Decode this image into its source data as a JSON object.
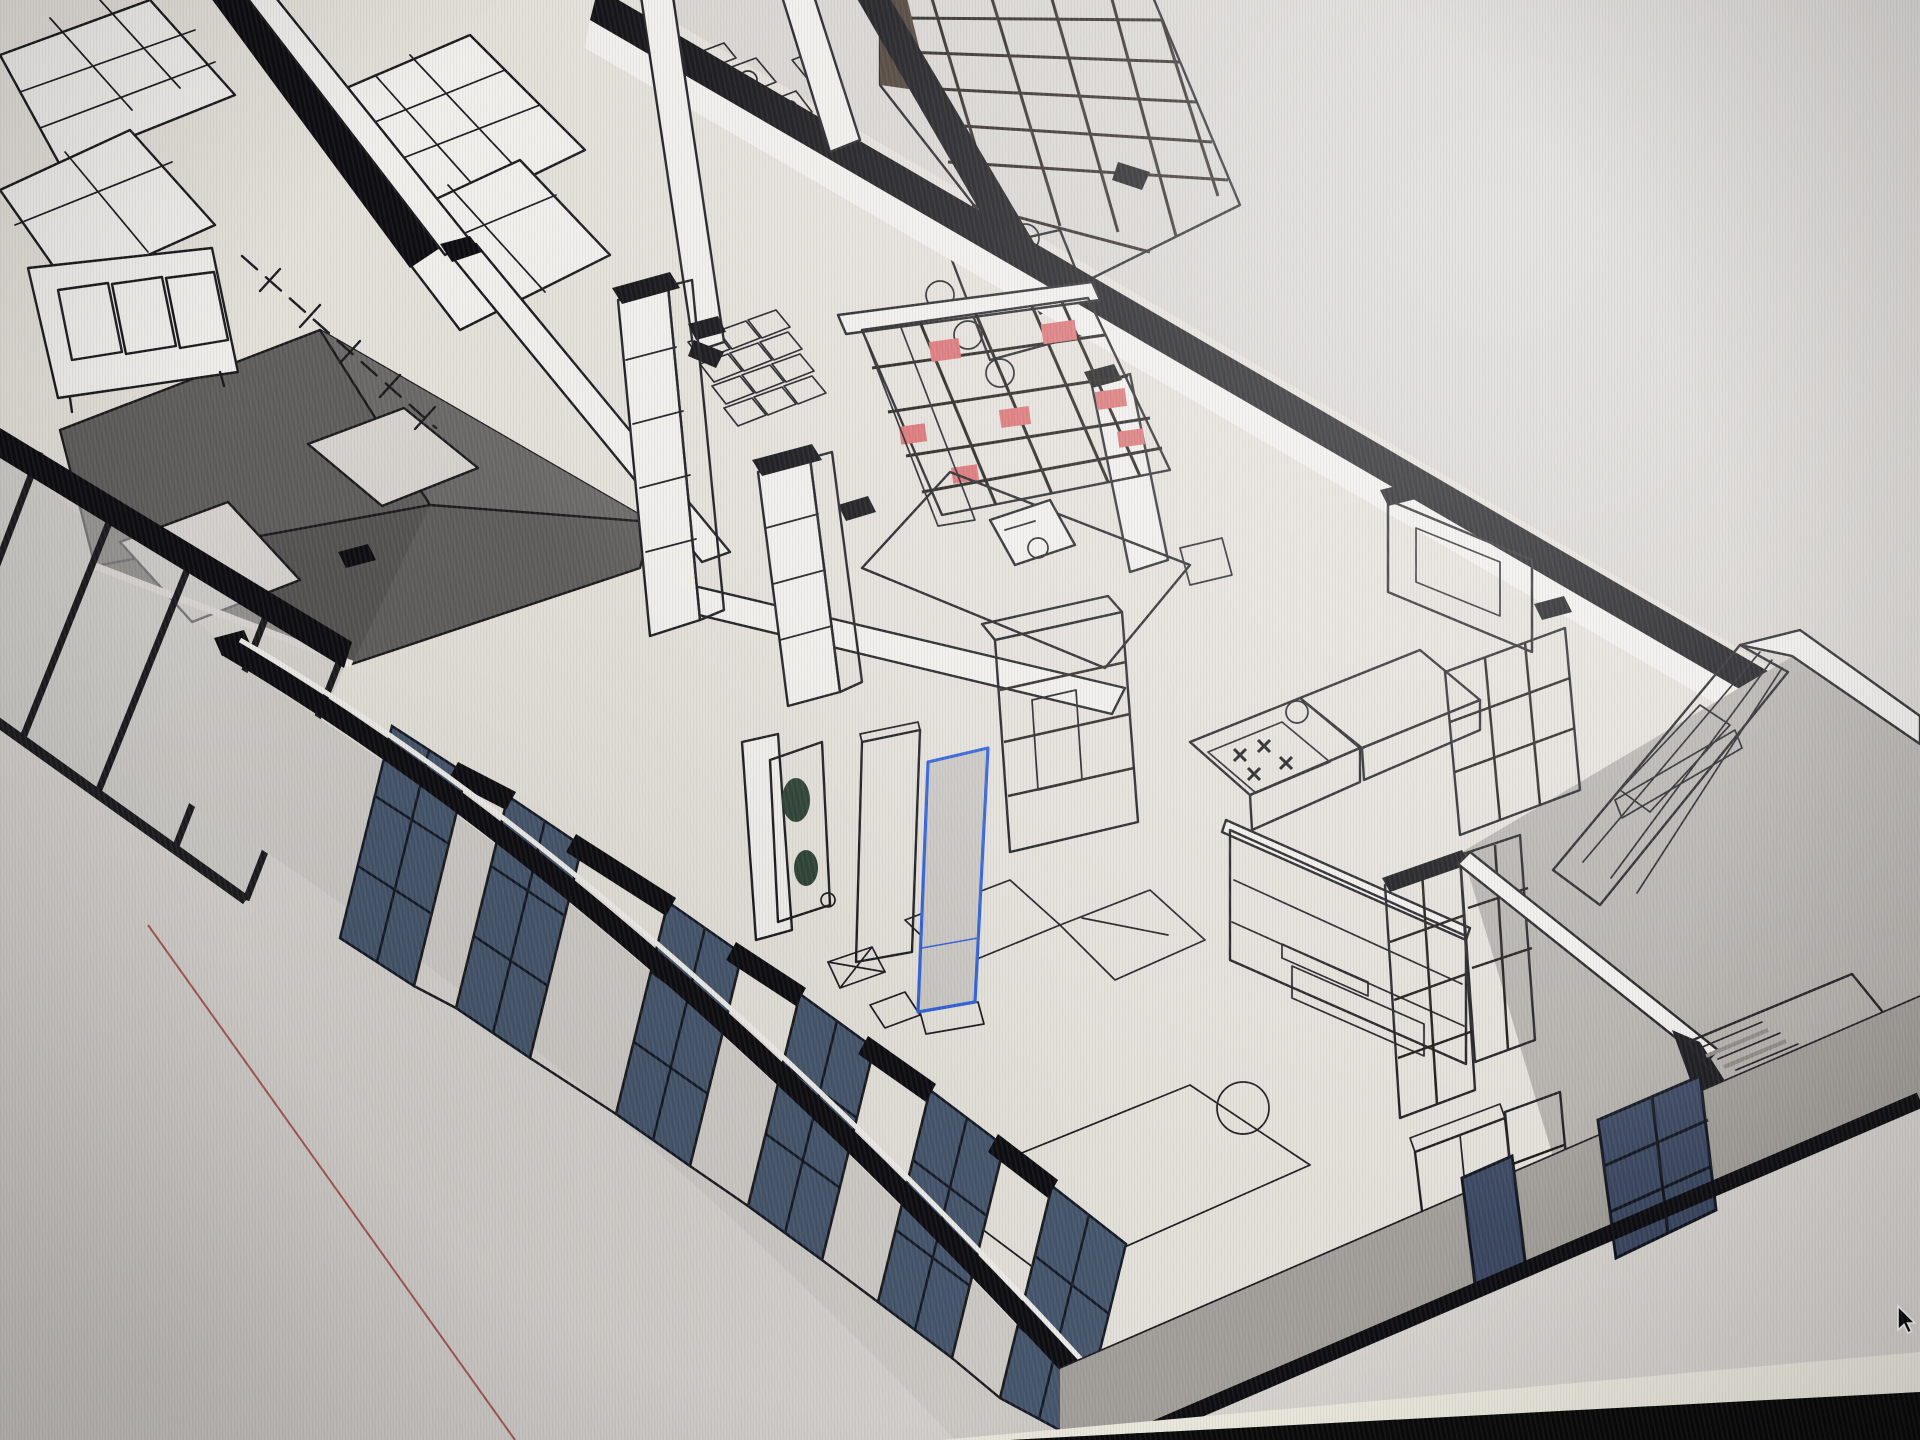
{
  "viewport": {
    "description": "axonometric cutaway of a building floor in a 3D modeling viewport, photographed on a monitor",
    "background": "#d7d4d0",
    "cursor": {
      "x": 1898,
      "y": 1306,
      "transform": "translate(1898,1306)",
      "glyph": "arrow"
    },
    "selection": {
      "color": "#2e5fd7",
      "target": "tall wardrobe panel"
    },
    "axis_line_color": "#a03c3c",
    "bezel_color": "#0a0a0b",
    "glare_band_color": "#ece9de"
  },
  "palette": {
    "bg": "#d7d4d0",
    "floor": "#e4e0da",
    "rug": "#eae7e2",
    "outline": "#1b1a1e",
    "section": "#0e0e12",
    "wall_white": "#f1efec",
    "wall_shade": "#d8d5d1",
    "pier": "#dbd8d4",
    "ext_wall": "#a29e99",
    "concrete": "#b4b1ac",
    "roof_dark": "#605e5c",
    "roof_mid": "#6b6967",
    "skylight": "#d7d4d0",
    "glass_blue": "#46566c",
    "glass_blue_dark": "#3a4760",
    "shelf_brown": "#8a6750",
    "shelf_brown_dark": "#43362d",
    "shelf_taupe": "#6e635a",
    "book_red": "#d96b6d",
    "cabinet_dark": "#46403b",
    "cabinet_mid": "#5a534d",
    "counter_brown": "#86735f",
    "counter_side": "#6b5b4b",
    "wood_tan": "#cdb98f",
    "tan_inset": "#d9c9a8",
    "plant_green": "#3d5743",
    "panel_gray": "#3f3e40",
    "console_dark": "#3a332e",
    "sel_blue": "#2e5fd7",
    "axis_red": "#a03c3c",
    "bezel": "#0a0a0b",
    "glare": "#ece9de",
    "stair_tread": "#c9c6c1",
    "stair_shadow": "#8e8b86"
  },
  "scene": {
    "elements": [
      "viewport-canvas",
      "section-cut-wall",
      "dashed-grid-line",
      "red-axis-line",
      "top-left-shelving",
      "credenza",
      "atrium-roof",
      "skylight",
      "glass-curtain-wall",
      "cafe-tables",
      "grid-tables",
      "meeting-table",
      "meeting-chairs",
      "brown-bookshelf-wall",
      "red-books-shelf",
      "shelf-column",
      "green-plant-panel",
      "desk-rug",
      "desk",
      "fireplace-cabinet",
      "sofa-plan-outline",
      "selected-panel",
      "dark-panel",
      "kitchen-counter",
      "cooktop",
      "sink",
      "media-wall",
      "media-console",
      "soundbar",
      "shelf-tower",
      "interior-window",
      "plank-wall",
      "stairs",
      "tan-cabinet",
      "window-wall",
      "blue-window",
      "exterior-wall",
      "screen-bezel",
      "glare-band",
      "mouse-cursor"
    ]
  }
}
